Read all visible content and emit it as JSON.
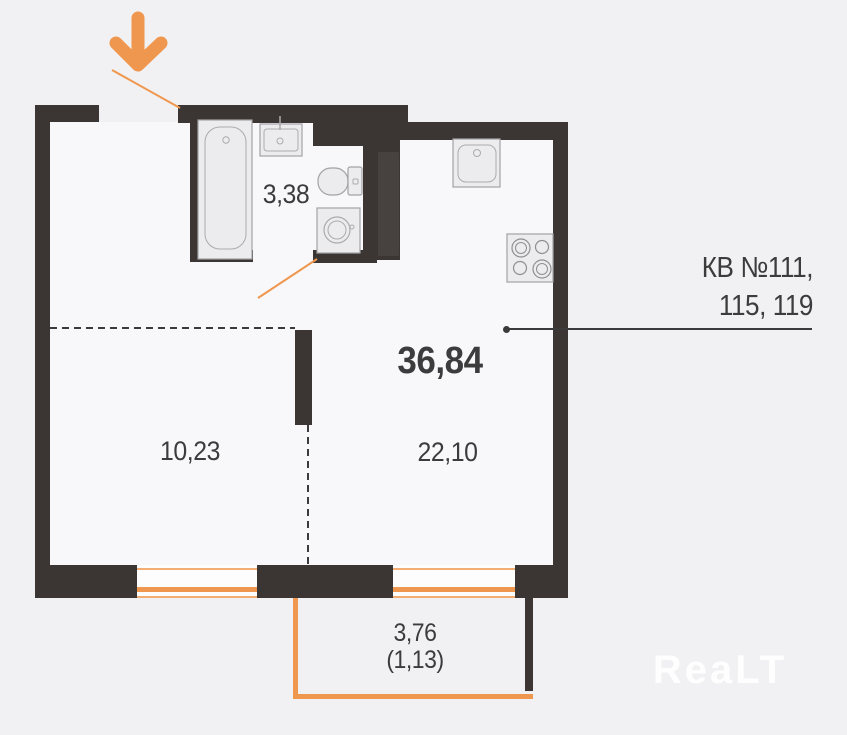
{
  "plan": {
    "apartment_numbers": {
      "line1": "КВ №111,",
      "line2": "115, 119"
    },
    "areas": {
      "total": "36,84",
      "bathroom": "3,38",
      "room": "10,23",
      "living": "22,10",
      "balcony": "3,76",
      "balcony_reduced": "(1,13)"
    },
    "watermark": "ReaLT",
    "icons": {
      "entrance": "entrance-arrow-down",
      "fixtures": [
        "bathtub-icon",
        "bath-sink-icon",
        "toilet-icon",
        "washing-machine-icon",
        "kitchen-sink-icon",
        "stove-icon"
      ]
    },
    "colors": {
      "wall": "#3B3634",
      "accent": "#F0974F",
      "background": "#F1F1F3",
      "interior": "#F8F8FA",
      "text": "#3C3C3C",
      "fixture_fill": "#ECECEE",
      "fixture_stroke": "#A3A3A6"
    }
  }
}
